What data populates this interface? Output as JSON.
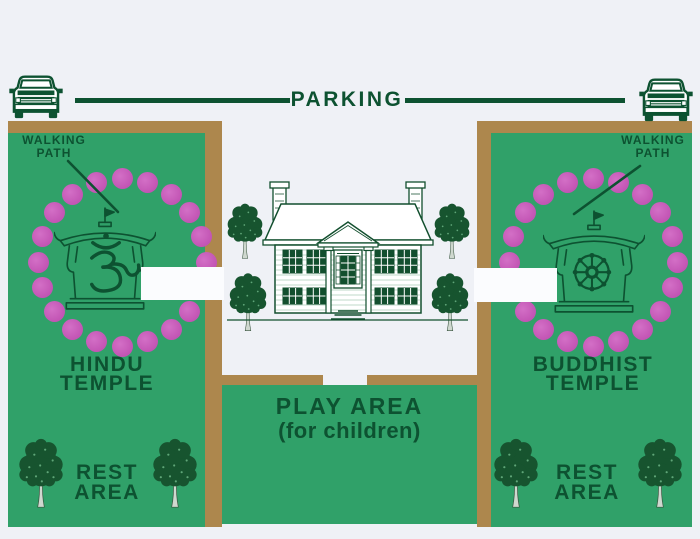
{
  "parking": {
    "label": "PARKING"
  },
  "hindu_zone": {
    "walking_path": {
      "line1": "WALKING",
      "line2": "PATH"
    },
    "title": {
      "line1": "HINDU",
      "line2": "TEMPLE"
    },
    "rest_area": {
      "line1": "REST",
      "line2": "AREA"
    },
    "symbol": "om"
  },
  "buddhist_zone": {
    "walking_path": {
      "line1": "WALKING",
      "line2": "PATH"
    },
    "title": {
      "line1": "BUDDHIST",
      "line2": "TEMPLE"
    },
    "rest_area": {
      "line1": "REST",
      "line2": "AREA"
    },
    "symbol": "dharma-wheel"
  },
  "play_area": {
    "title": "PLAY AREA",
    "subtitle": "(for children)"
  },
  "walking_circles": {
    "left": {
      "cx": 122,
      "cy": 262,
      "r": 84,
      "count": 20,
      "dot_r": 10.5
    },
    "right": {
      "cx": 593,
      "cy": 262,
      "r": 84,
      "count": 20,
      "dot_r": 10.5
    }
  },
  "colors": {
    "lawn_green": "#30a169",
    "path_brown": "#ad874d",
    "flower_pink": "#c655b6",
    "ink_green": "#0d5231",
    "background": "#eff1f6",
    "path_white": "#fbfcfe"
  }
}
